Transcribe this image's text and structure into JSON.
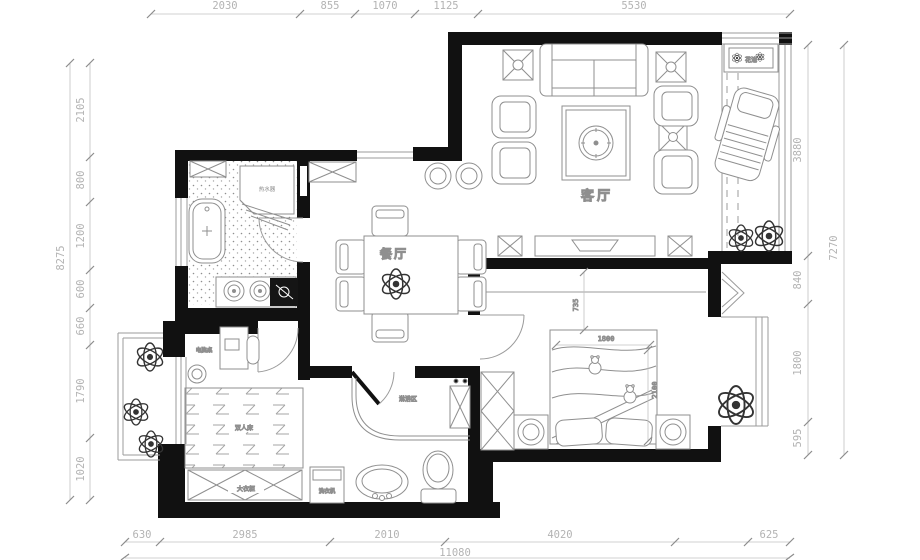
{
  "plan": {
    "rooms": {
      "living": "客厅",
      "dining": "餐厅"
    },
    "furniture": {
      "wardrobe": "大衣柜",
      "washer": "洗衣机",
      "shower": "淋浴区",
      "desk": "电脑桌",
      "bed": "双人床",
      "heater": "热水器",
      "planter": "花池"
    },
    "bed_dims": {
      "offset": "735",
      "width": "1800",
      "depth": "2100"
    },
    "dims": {
      "top": [
        "2030",
        "855",
        "1070",
        "1125",
        "5530"
      ],
      "left": [
        "2105",
        "800",
        "1200",
        "600",
        "660",
        "1790",
        "1020"
      ],
      "left_total": "8275",
      "right": [
        "3880",
        "840",
        "1800",
        "595"
      ],
      "right_total": "7270",
      "bottom": [
        "630",
        "2985",
        "2010",
        "4020",
        "625"
      ],
      "bottom_total": "11080"
    },
    "colors": {
      "wall": "#111111",
      "line": "#9b9b9b",
      "dim": "#b3b3b3",
      "label": "#333333"
    }
  }
}
